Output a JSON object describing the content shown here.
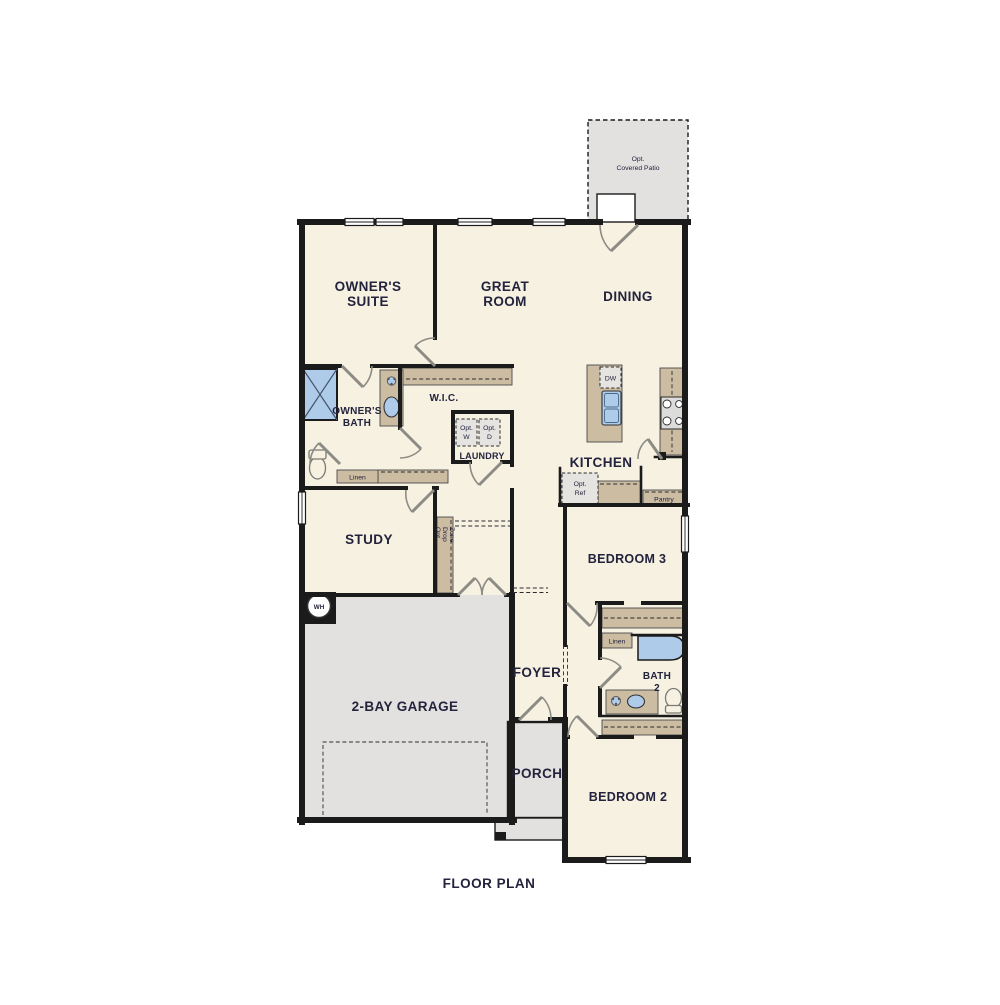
{
  "title": "FLOOR PLAN",
  "patio": {
    "line1": "Opt.",
    "line2": "Covered Patio"
  },
  "rooms": {
    "owners_suite": {
      "line1": "OWNER'S",
      "line2": "SUITE"
    },
    "great_room": {
      "line1": "GREAT",
      "line2": "ROOM"
    },
    "dining": {
      "label": "DINING"
    },
    "owners_bath": {
      "line1": "OWNER'S",
      "line2": "BATH"
    },
    "wic": {
      "label": "W.I.C."
    },
    "laundry": {
      "label": "LAUNDRY"
    },
    "kitchen": {
      "label": "KITCHEN"
    },
    "study": {
      "label": "STUDY"
    },
    "bedroom3": {
      "label": "BEDROOM 3"
    },
    "foyer": {
      "label": "FOYER"
    },
    "bath2": {
      "line1": "BATH",
      "line2": "2"
    },
    "garage": {
      "label": "2-BAY GARAGE"
    },
    "porch": {
      "label": "PORCH"
    },
    "bedroom2": {
      "label": "BEDROOM 2"
    }
  },
  "annotations": {
    "dw": "DW",
    "opt_w": {
      "line1": "Opt.",
      "line2": "W"
    },
    "opt_d": {
      "line1": "Opt.",
      "line2": "D"
    },
    "opt_ref": {
      "line1": "Opt.",
      "line2": "Ref"
    },
    "pantry": "Pantry",
    "linen_owners_bath": "Linen",
    "linen_hall": "Linen",
    "water_heater": "WH",
    "drop_zone": {
      "line1": "Opt.",
      "line2": "Drop",
      "line3": "Zone"
    }
  },
  "colors": {
    "wall": "#1b1b1b",
    "room_fill": "#f7f1e2",
    "counter_fill": "#cbbca2",
    "concrete_fill": "#e3e1df",
    "fixture_blue": "#aecbe9",
    "door_swing": "#8c8c84",
    "label_text": "#23233d"
  }
}
